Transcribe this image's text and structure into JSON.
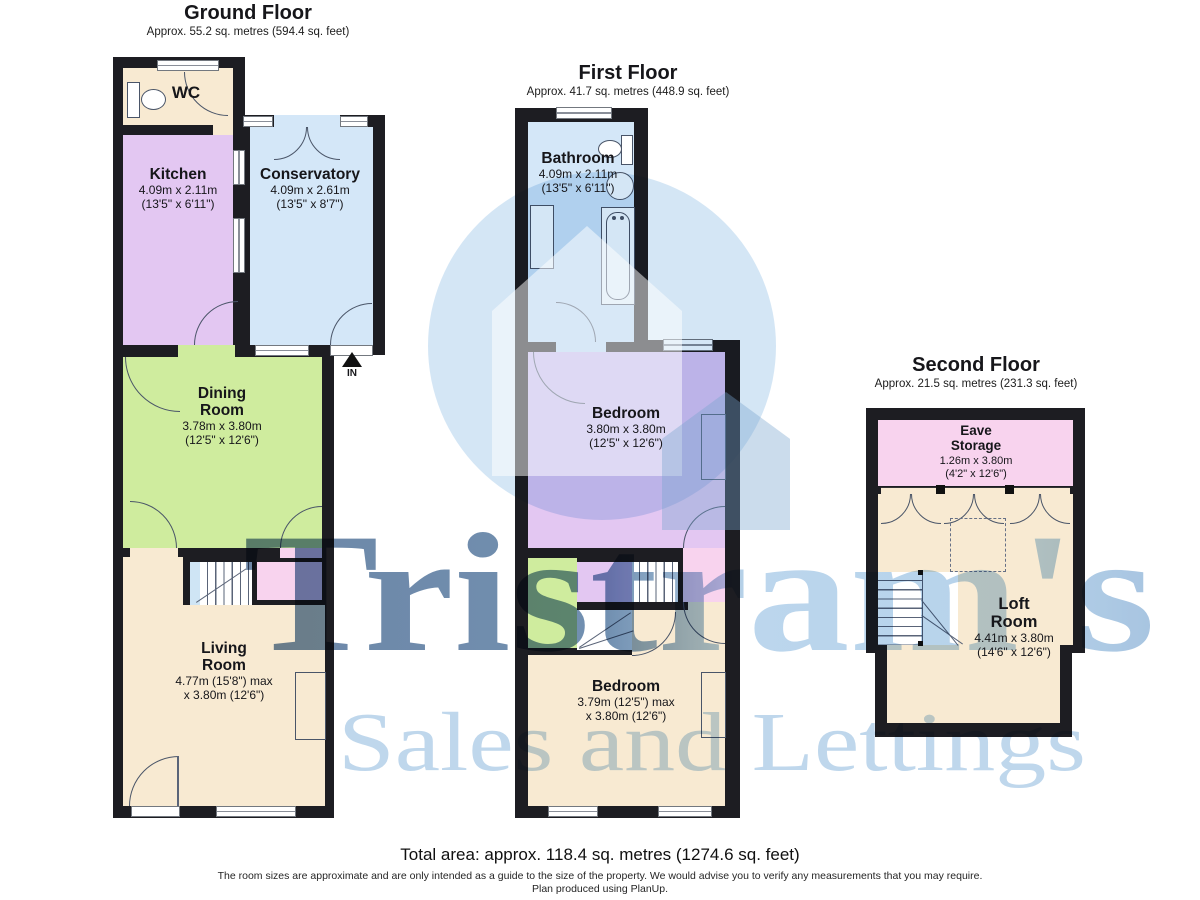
{
  "floors": [
    {
      "title": "Ground Floor",
      "subtitle": "Approx. 55.2 sq. metres (594.4 sq. feet)",
      "entrance_label": "IN",
      "rooms": [
        {
          "name": "WC"
        },
        {
          "name": "Kitchen",
          "dim1": "4.09m x 2.11m",
          "dim2": "(13'5\" x 6'11\")"
        },
        {
          "name": "Conservatory",
          "dim1": "4.09m x 2.61m",
          "dim2": "(13'5\" x 8'7\")"
        },
        {
          "name": "Dining Room",
          "dim1": "3.78m x 3.80m",
          "dim2": "(12'5\" x 12'6\")"
        },
        {
          "name": "Living Room",
          "dim1": "4.77m (15'8\") max",
          "dim2": "x 3.80m (12'6\")"
        }
      ]
    },
    {
      "title": "First Floor",
      "subtitle": "Approx. 41.7 sq. metres (448.9 sq. feet)",
      "rooms": [
        {
          "name": "Bathroom",
          "dim1": "4.09m x 2.11m",
          "dim2": "(13'5\" x 6'11\")"
        },
        {
          "name": "Bedroom",
          "dim1": "3.80m x 3.80m",
          "dim2": "(12'5\" x 12'6\")"
        },
        {
          "name": "Bedroom",
          "dim1": "3.79m (12'5\") max",
          "dim2": "x 3.80m (12'6\")"
        }
      ]
    },
    {
      "title": "Second Floor",
      "subtitle": "Approx. 21.5 sq. metres (231.3 sq. feet)",
      "rooms": [
        {
          "name": "Eave Storage",
          "dim1": "1.26m x 3.80m",
          "dim2": "(4'2\" x 12'6\")"
        },
        {
          "name": "Loft Room",
          "dim1": "4.41m x 3.80m",
          "dim2": "(14'6\" x 12'6\")"
        }
      ]
    }
  ],
  "watermark": {
    "brand": "Tristram's",
    "tagline": "Sales and Lettings",
    "logo": "house-in-circle-logo"
  },
  "footer": {
    "total": "Total area: approx. 118.4 sq. metres (1274.6 sq. feet)",
    "disclaimer": "The room sizes are approximate and are only intended as a guide to the size of the property. We would advise you to verify any measurements that you may require.",
    "produced": "Plan produced using PlanUp."
  },
  "colors": {
    "wall": "#1d1d22",
    "room_cream": "#f8ead2",
    "room_purple": "#e3c7f2",
    "room_blue": "#d4e7f8",
    "room_green": "#cfec9e",
    "room_pink": "#f8d3ee",
    "brand_dark_blue": "#47709b",
    "brand_light_blue": "#a9cbe8",
    "tagline_blue": "#b9d3ea"
  }
}
